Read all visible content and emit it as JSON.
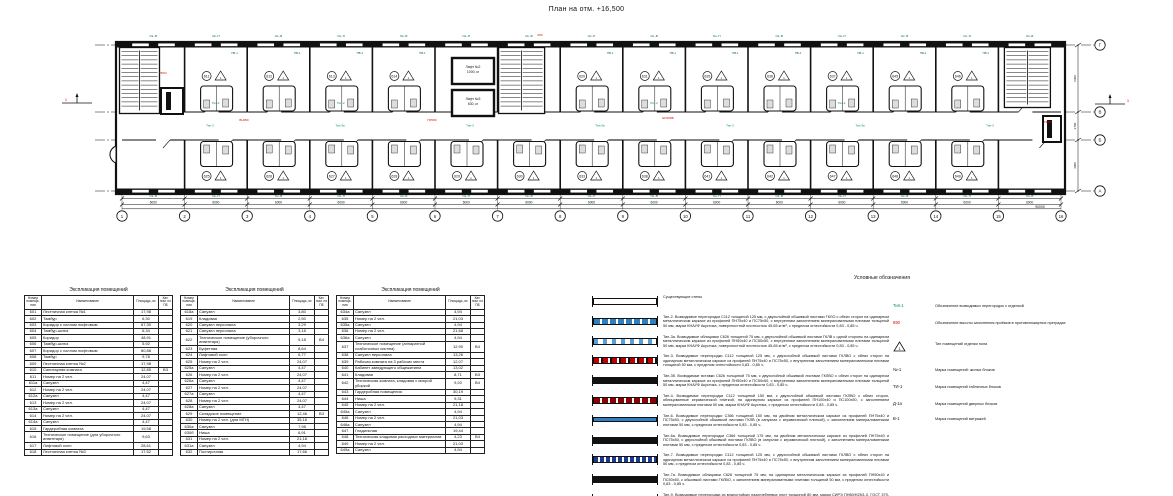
{
  "title": "План на отм. +16,500",
  "plan": {
    "grid_columns": [
      "1",
      "2",
      "3",
      "4",
      "5",
      "6",
      "7",
      "8",
      "9",
      "10",
      "11",
      "12",
      "13",
      "14",
      "15",
      "16"
    ],
    "grid_rows": [
      "Г",
      "В",
      "Б",
      "А"
    ],
    "bay_dimension": "6000",
    "total_dimension": "90000",
    "vertical_dimensions": [
      "6300",
      "2700",
      "4900"
    ],
    "window_mark_a": "Ок.-В",
    "window_mark_b": "Ок.-П",
    "room_window_mark": "ПВ-1",
    "elevator_1": [
      "Лифт №2",
      "1000, кг"
    ],
    "elevator_2": [
      "Лифт №3",
      "630, кг"
    ],
    "section_mark": "1",
    "triangle_mark": "1",
    "top_room_numbers": [
      "611",
      "612",
      "613",
      "614",
      "620",
      "631",
      "635",
      "636",
      "637",
      "645",
      "646"
    ],
    "bottom_room_numbers": [
      "625",
      "626",
      "627",
      "628",
      "629",
      "630",
      "633",
      "638",
      "641",
      "642",
      "647",
      "648",
      "649"
    ],
    "room_type_label": "Тип-2",
    "corridor_type_labels": [
      "Тип-3",
      "Тип-3а",
      "Тип-3",
      "Тип-3а",
      "Тип-3",
      "Тип-3а",
      "Тип-3"
    ],
    "red_marks": [
      {
        "text": "ПР02",
        "x": 163,
        "y": 74
      },
      {
        "text": "ВН050",
        "x": 244,
        "y": 121
      },
      {
        "text": "ПР060",
        "x": 432,
        "y": 121
      },
      {
        "text": "690",
        "x": 540,
        "y": 36
      },
      {
        "text": "ЕИ150В",
        "x": 668,
        "y": 119
      },
      {
        "text": "ПР02",
        "x": 1048,
        "y": 123
      }
    ],
    "colors": {
      "green": "#008a5a",
      "teal": "#006655",
      "red": "#e00000",
      "line": "#111111",
      "blue": "#2f7fc1"
    }
  },
  "tables": [
    {
      "title": "Экспликация помещений",
      "columns": [
        "Номер помеще- ния",
        "Наименование",
        "Площадь, м²",
        "Кат. пом. по ПБ"
      ],
      "rows": [
        [
          "601",
          "Лестничная клетка №1",
          "17,98",
          ""
        ],
        [
          "602",
          "Тамбур",
          "6,30",
          ""
        ],
        [
          "603",
          "Коридор с холлом лифтовым",
          "67,30",
          ""
        ],
        [
          "604",
          "Тамбур-шлюз",
          "6,34",
          ""
        ],
        [
          "605",
          "Коридор",
          "48,91",
          ""
        ],
        [
          "606",
          "Тамбур-шлюз",
          "5,92",
          ""
        ],
        [
          "607",
          "Коридор с холлом лифтовым",
          "80,88",
          ""
        ],
        [
          "608",
          "Тамбур",
          "9,78",
          ""
        ],
        [
          "609",
          "Лестничная клетка №2",
          "17,98",
          ""
        ],
        [
          "610",
          "Санитарная комната",
          "12,85",
          "В3"
        ],
        [
          "611",
          "Номер на 2 чел.",
          "24,07",
          ""
        ],
        [
          "611а",
          "Санузел",
          "4,47",
          ""
        ],
        [
          "612",
          "Номер на 2 чел.",
          "24,07",
          ""
        ],
        [
          "612а",
          "Санузел",
          "4,47",
          ""
        ],
        [
          "613",
          "Номер на 2 чел.",
          "24,07",
          ""
        ],
        [
          "613а",
          "Санузел",
          "4,47",
          ""
        ],
        [
          "614",
          "Номер на 2 чел.",
          "24,07",
          ""
        ],
        [
          "614а",
          "Санузел",
          "4,47",
          ""
        ],
        [
          "615",
          "Гардеробная комната",
          "19,58",
          ""
        ],
        [
          "616",
          "Техническое помещение (для уборочного инвентаря)",
          "9,63",
          ""
        ],
        [
          "617",
          "Лифтовой холл",
          "28,61",
          ""
        ],
        [
          "618",
          "Лестничная клетка №3",
          "17,52",
          ""
        ]
      ]
    },
    {
      "title": "Экспликация помещений",
      "columns": [
        "Номер помеще- ния",
        "Наименование",
        "Площадь, м²",
        "Кат. пом. по ПБ"
      ],
      "rows": [
        [
          "618а",
          "Санузел",
          "3,80",
          ""
        ],
        [
          "619",
          "Кладовая",
          "2,50",
          ""
        ],
        [
          "620",
          "Санузел персонала",
          "3,29",
          ""
        ],
        [
          "621",
          "Санузел персонала",
          "3,18",
          ""
        ],
        [
          "622",
          "Техническое помещение (уборочного инвентаря)",
          "5,18",
          "В4"
        ],
        [
          "623",
          "Буфетная",
          "8,64",
          ""
        ],
        [
          "624",
          "Лифтовой холл",
          "6,77",
          ""
        ],
        [
          "625",
          "Номер на 2 чел.",
          "24,07",
          ""
        ],
        [
          "625а",
          "Санузел",
          "4,47",
          ""
        ],
        [
          "626",
          "Номер на 2 чел.",
          "24,07",
          ""
        ],
        [
          "626а",
          "Санузел",
          "4,47",
          ""
        ],
        [
          "627",
          "Номер на 2 чел.",
          "24,07",
          ""
        ],
        [
          "627а",
          "Санузел",
          "4,47",
          ""
        ],
        [
          "628",
          "Номер на 2 чел.",
          "24,07",
          ""
        ],
        [
          "628а",
          "Санузел",
          "4,47",
          ""
        ],
        [
          "629",
          "Складское помещение",
          "12,46",
          "В3"
        ],
        [
          "630",
          "Номер на 2 чел. (для МГН)",
          "35,16",
          ""
        ],
        [
          "630а",
          "Санузел",
          "7,98",
          ""
        ],
        [
          "630б",
          "Ниша",
          "6,91",
          ""
        ],
        [
          "631",
          "Номер на 2 чел.",
          "21,18",
          ""
        ],
        [
          "631а",
          "Санузел",
          "4,94",
          ""
        ],
        [
          "632",
          "Постирочная",
          "17,66",
          ""
        ]
      ]
    },
    {
      "title": "Экспликация помещений",
      "columns": [
        "Номер помеще- ния",
        "Наименование",
        "Площадь, м²",
        "Кат. пом. по ПБ"
      ],
      "rows": [
        [
          "634а",
          "Санузел",
          "4,94",
          ""
        ],
        [
          "635",
          "Номер на 2 чел.",
          "21,03",
          ""
        ],
        [
          "635а",
          "Санузел",
          "4,94",
          ""
        ],
        [
          "636",
          "Номер на 2 чел.",
          "21,68",
          ""
        ],
        [
          "636а",
          "Санузел",
          "4,94",
          ""
        ],
        [
          "637",
          "Техническое помещение (аппаратной слаботочных систем)",
          "12,90",
          "В4"
        ],
        [
          "638",
          "Санузел персонала",
          "13,26",
          ""
        ],
        [
          "639",
          "Рабочая комната на 3 рабочих места",
          "12,07",
          ""
        ],
        [
          "640",
          "Кабинет заведующего общежитием",
          "13,02",
          ""
        ],
        [
          "641",
          "Кладовая",
          "8,71",
          "В3"
        ],
        [
          "642",
          "Техническая комната, кладовая с мокрой уборкой",
          "9,20",
          "В4"
        ],
        [
          "643",
          "Гардеробная помещения",
          "30,19",
          ""
        ],
        [
          "644",
          "Ниша",
          "9,31",
          ""
        ],
        [
          "645",
          "Номер на 2 чел.",
          "21,18",
          ""
        ],
        [
          "645а",
          "Санузел",
          "4,94",
          ""
        ],
        [
          "646",
          "Номер на 2 чел.",
          "21,03",
          ""
        ],
        [
          "646а",
          "Санузел",
          "4,94",
          ""
        ],
        [
          "647",
          "Гладильная",
          "19,44",
          ""
        ],
        [
          "648",
          "Техническая кладовая расходных материалов",
          "4,23",
          "В4"
        ],
        [
          "649",
          "Номер на 2 чел.",
          "21,03",
          ""
        ],
        [
          "649а",
          "Санузел",
          "4,94",
          ""
        ]
      ]
    }
  ],
  "legend": {
    "title": "Условные обозначения",
    "wall_types": [
      {
        "bar": "plain",
        "text": "Существующие стены"
      },
      {
        "bar": "blue",
        "text": "Тип-2. Возводимые перегородки С112 толщиной 125 мм, с двухслойной обшивкой листами ГКЛО с обеих сторон на одинарном металлическом каркасе из профилей ПН75х40 и ПС75х50, с внутренним заполнением минераловатными плитами толщиной 50 мм, марки КНАУФ Акустика, поверхностной плотностью 45-65 кг/м³, с пределом огнестойкости 0,83 - 0,85 ч."
      },
      {
        "bar": "blue2",
        "text": "Тип-3а. Возводимые облицовки С626 толщиной 75 мм, с двухслойной обшивкой листами ГКЛВ с одной стороны на одинарном металлическом каркасе из профилей ПН50х40 и ПС50х50, с внутренним заполнением минераловатными плитами толщиной 50 мм, марки КНАУФ Акустика, поверхностной плотностью 45-65 кг/м³, с пределом огнестойкости 0,83 - 0,85 ч."
      },
      {
        "bar": "red",
        "text": "Тип-3. Возводимые перегородки С112 толщиной 125 мм, с двухслойной обшивкой листами ГКЛВО с обеих сторон на одинарном металлическом каркасе из профилей ПН75х40 и ПС75х50, с внутренним заполнением минераловатными плитами толщиной 50 мм, с пределом огнестойкости 0,83 - 0,85 ч."
      },
      {
        "bar": "black",
        "text": "Тип-3б. Возводимые вставки С626 толщиной 75 мм, с двухслойной обшивкой листами ГКЛВО с обеих сторон на одинарном металлическом каркасе из профилей ПН50х40 и ПС50х50, с внутренним заполнением минераловатными плитами толщиной 50 мм, марки КНАУФ Акустика, с пределом огнестойкости 0,83 - 0,85 ч."
      },
      {
        "bar": "dred",
        "text": "Тип-4. Возводимые перегородки С112 толщиной 150 мм, с двухслойной обшивкой листами ГКЛВО с обеих сторон, облицованные керамической плиткой, на одинарном каркасе из профилей ПН100х40 и ПС100х50, с заполнением минераловатными плитами 50 мм, марки КНАУФ Акустика, с пределом огнестойкости 0,83 - 0,85 ч."
      },
      {
        "bar": "bluethin",
        "text": "Тип-6. Возводимые перегородки С366 толщиной 150 мм, на двойном металлическом каркасе из профилей ПН75х40 и ПС75х50, с двухслойной обшивкой листами ГКЛВ (в санузлах с керамической плиткой), с заполнением минераловатными плитами 50 мм, с пределом огнестойкости 0,83 - 0,85 ч."
      },
      {
        "bar": "black",
        "text": "Тип-6а. Возводимые перегородки С366 толщиной 175 мм, на двойном металлическом каркасе из профилей ПН75х40 и ПС75х50, с двухслойной обшивкой листами ГКЛВО (в санузлах с керамической плиткой), с заполнением минераловатными плитами 50 мм, с пределом огнестойкости 0,83 - 0,85 ч."
      },
      {
        "bar": "navy",
        "text": "Тип-7. Возводимые перегородки С112 толщиной 125 мм, с двухслойной обшивкой листами ГКЛВО с обеих сторон на одинарном металлическом каркасе из профилей ПН75х40 и ПС75х50, с внутренним заполнением минераловатными плитами 50 мм, с пределом огнестойкости 0,83 - 0,85 ч."
      },
      {
        "bar": "black",
        "text": "Тип-7а. Возводимые облицовки С626 толщиной 75 мм, на одинарном металлическом каркасе из профилей ПН50х40 и ПС50х50, с обшивкой листами ГКЛВО, с заполнением минераловатными плитами толщиной 50 мм, с пределом огнестойкости 0,83 - 0,85 ч."
      },
      {
        "bar": "reddash",
        "text": "Тип-9. Возводимые перегородки из влагостойких пазогребневых плит толщиной 80 мм, марки СИРЭ ПН80/Н25/1,0, ГОСТ 379-2015."
      }
    ],
    "marks": [
      {
        "label": "Тип-1",
        "color": "#008a5a",
        "triangle": false,
        "text": "Обозначение возводимых перегородок с отделкой",
        "top": 8
      },
      {
        "label": "690",
        "color": "#e00000",
        "triangle": false,
        "text": "Обозначение высоты заполнения проёмов в противопожарных преградах",
        "top": 25
      },
      {
        "label": "1",
        "color": "#111111",
        "triangle": true,
        "text": "Тип помещений отделки пола",
        "top": 46
      },
      {
        "label": "№-1",
        "color": "#111111",
        "triangle": false,
        "text": "Марка помещений: жилых блоков",
        "top": 72
      },
      {
        "label": "ТИ-1",
        "color": "#111111",
        "triangle": false,
        "text": "Марка помещений табличных блоков",
        "top": 89
      },
      {
        "label": "Д-1а",
        "color": "#111111",
        "triangle": false,
        "text": "Марка помещений дверных блоков",
        "top": 106
      },
      {
        "label": "В-1",
        "color": "#111111",
        "triangle": false,
        "text": "Марка помещений витражей",
        "top": 121
      }
    ]
  }
}
